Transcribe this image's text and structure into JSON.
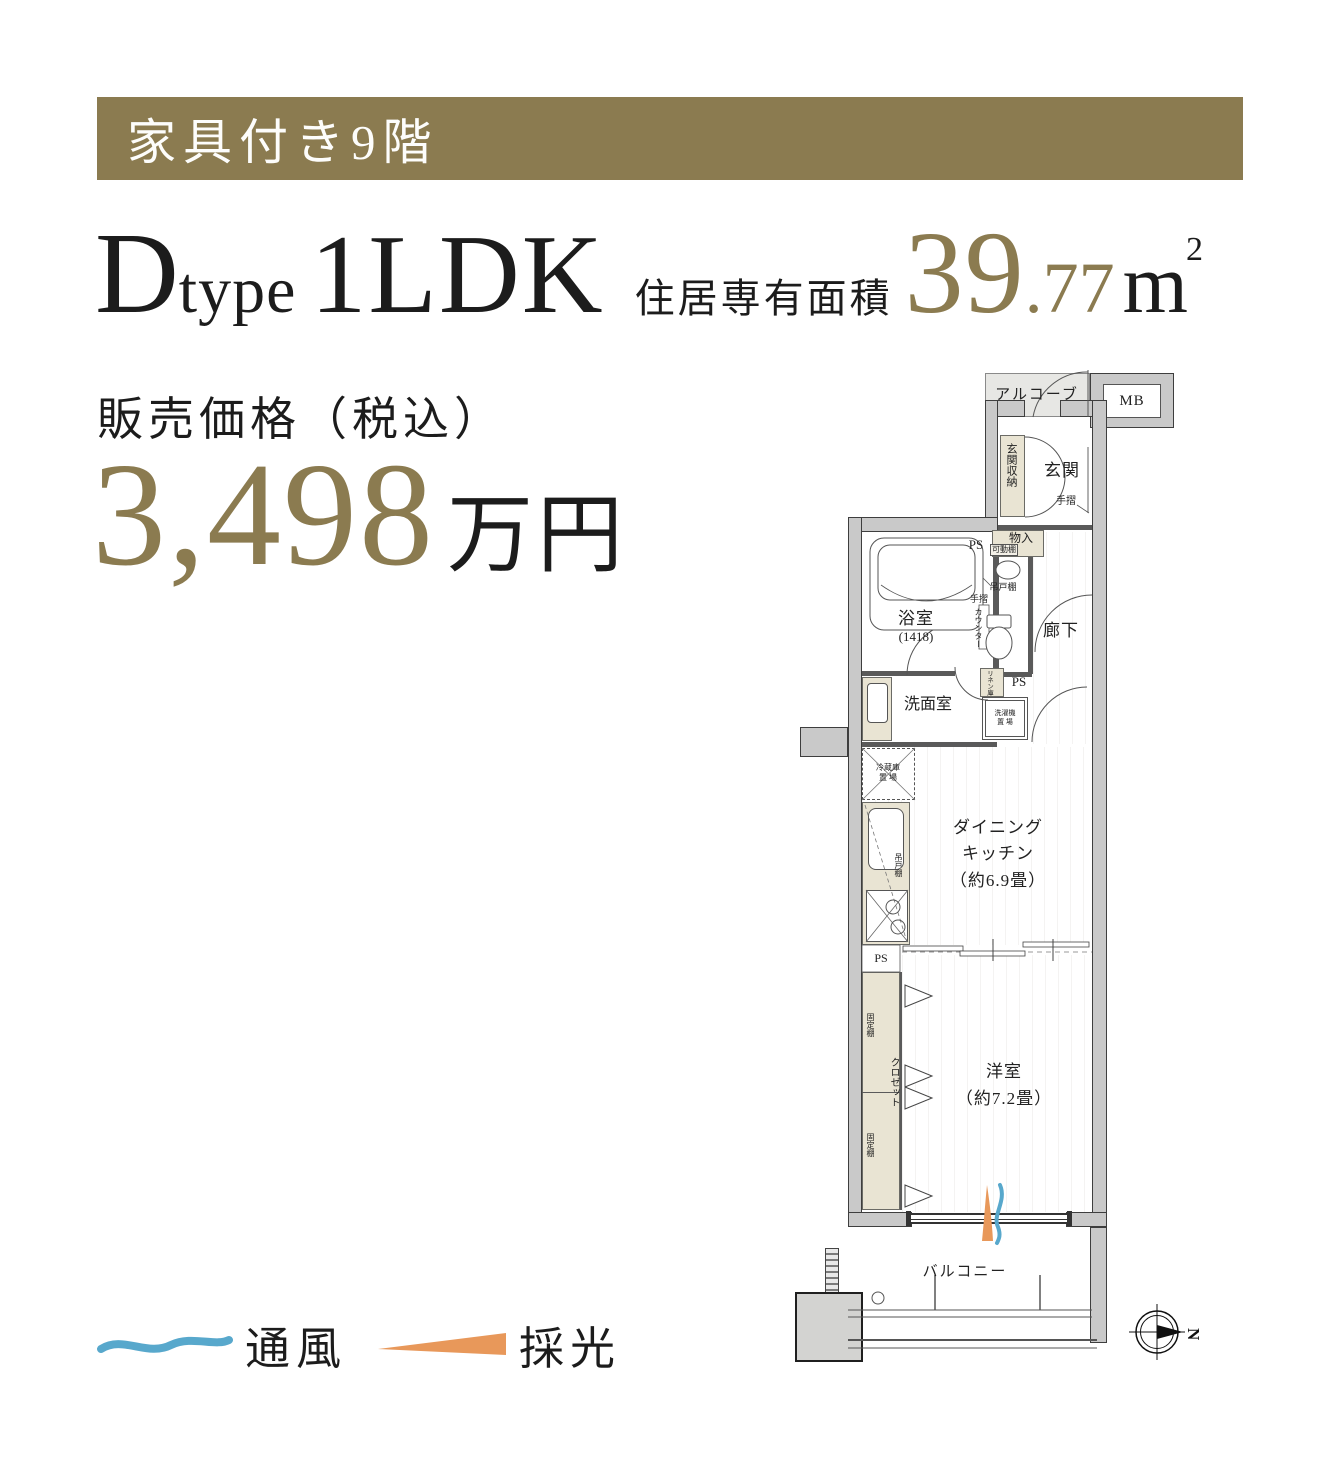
{
  "banner": {
    "label": "家具付き9階",
    "bg": "#8b7b50"
  },
  "title": {
    "d": "D",
    "type": "type",
    "ldk": "1LDK",
    "area_label": "住居専有面積",
    "area_int": "39",
    "area_dec": ".77",
    "area_unit": "m",
    "area_sup": "2"
  },
  "price": {
    "label": "販売価格（税込）",
    "value": "3,498",
    "unit": "万円"
  },
  "plan": {
    "alcove": "アルコーブ",
    "mb": "MB",
    "genkan": "玄関",
    "genkan_storage": "玄関収納",
    "tesuri": "手摺",
    "monoire": "物入",
    "kadodana": "可動棚",
    "ps": "PS",
    "bath_name": "浴室",
    "bath_size": "(1418)",
    "tsuridana": "吊戸棚",
    "counter": "カウンター",
    "hallway": "廊下",
    "linen": "リネン庫",
    "washer_l1": "洗濯機",
    "washer_l2": "置 場",
    "senmen": "洗面室",
    "fridge_l1": "冷蔵庫",
    "fridge_l2": "置 場",
    "dk_l1": "ダイニング",
    "dk_l2": "キッチン",
    "dk_l3": "（約6.9畳）",
    "kotei": "固定棚",
    "closet": "クロゼット",
    "west_l1": "洋室",
    "west_l2": "（約7.2畳）",
    "balcony": "バルコニー",
    "north": "N"
  },
  "legend": {
    "vent": "通風",
    "light": "採光"
  },
  "colors": {
    "gold": "#8b7b50",
    "vent_blue": "#58a8cc",
    "light_orange": "#e8985a"
  },
  "icons": {
    "vent": "wave-stroke-icon",
    "light": "wedge-icon",
    "compass": "compass-rose-icon"
  }
}
